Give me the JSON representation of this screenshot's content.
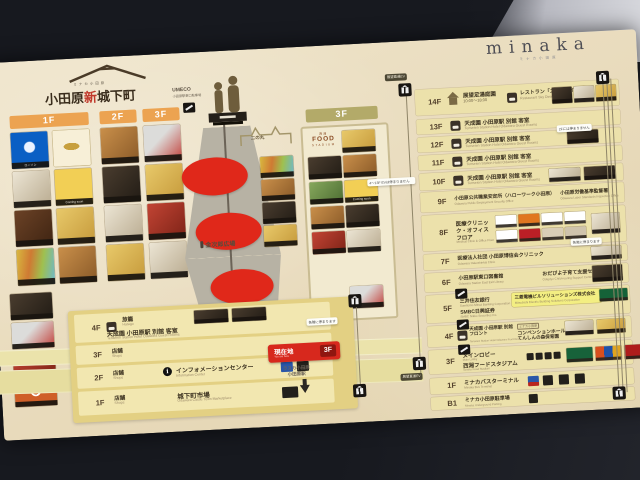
{
  "shinjokamachi": {
    "brand_small": "ミナカ小田原",
    "title_pre": "小田原",
    "title_accent": "新",
    "title_post": "城下町",
    "floor1": "1F",
    "floor2": "2F",
    "floor3": "3F",
    "lawson_label": "ローソン",
    "coming_soon": "Coming soon"
  },
  "directory": {
    "rows": [
      {
        "floor": "4F",
        "category": "旅籠",
        "category_en": "Hatago",
        "name": "天成園 小田原駅 別館 客室",
        "name_en": "Tenseien Station Hotel Odawara Guest Rooms"
      },
      {
        "floor": "3F",
        "category": "店舗",
        "category_en": "Shops",
        "name": "",
        "name_en": ""
      },
      {
        "floor": "2F",
        "category": "店舗",
        "category_en": "Shops",
        "name": "インフォメーションセンター",
        "name_en": "Information Center"
      },
      {
        "floor": "1F",
        "category": "店舗",
        "category_en": "Shops",
        "name": "城下町市場",
        "name_en": "Odawara Castle Town Marketplace"
      }
    ],
    "elevator_note": "各階に停まります"
  },
  "center": {
    "umeco": "UMECO",
    "umeco_sub": "小田原駅東口駐車場",
    "ninomaru": "二の丸",
    "plaza": "金次郎広場",
    "here_label": "現在地",
    "here_en": "You are here",
    "here_floor": "3F",
    "station_line1": "ラスカ小田原",
    "station_line2": "小田原駅"
  },
  "food_stadium": {
    "floor": "3F",
    "logo_top": "西湘",
    "logo_main": "FOOD",
    "logo_sub": "STADIUM",
    "coming_soon": "Coming soon"
  },
  "minaka": {
    "logo": "minaka",
    "logo_sub": "ミナカ小田原",
    "rows": [
      {
        "floor": "14F",
        "area": "展望足湯庭園",
        "area_time": "10:00〜18:00",
        "name": "レストラン「スカイダイニング」",
        "name_en": "Restaurant Sky Dining"
      },
      {
        "floor": "13F",
        "name": "天成園 小田原駅 別館 客室",
        "name_en": "Tenseien Station Hotel Odawara Guest Rooms"
      },
      {
        "floor": "12F",
        "name": "天成園 小田原駅 別館 客室",
        "name_en": "Tenseien Station Hotel Odawara Guest Rooms"
      },
      {
        "floor": "11F",
        "name": "天成園 小田原駅 別館 客室",
        "name_en": "Tenseien Station Hotel Odawara Guest Rooms"
      },
      {
        "floor": "10F",
        "name": "天成園 小田原駅 別館 客室",
        "name_en": "Tenseien Station Hotel Odawara Guest Rooms"
      },
      {
        "floor": "9F",
        "name": "小田原公共職業安定所（ハローワーク小田原）",
        "name_en": "Odawara Public Employment Security Office",
        "name2": "小田原労働基準監督署",
        "name2_en": "Odawara Labor Standards Inspection Office"
      },
      {
        "floor": "8F",
        "name": "医療クリニック・オフィス フロア",
        "name_en": "Medical Clinic & Office Floor"
      },
      {
        "floor": "7F",
        "name": "医療法人社団 小田原博信会クリニック",
        "name_en": "Odawara Hakushinkai Clinic"
      },
      {
        "floor": "6F",
        "name": "小田原駅東口図書館",
        "name_en": "Odawara Station East Exit Library",
        "name2": "おだぴよ子育て支援センター",
        "name2_en": "Odapiyo Child-rearing Support Center"
      },
      {
        "floor": "5F",
        "name": "三井住友銀行",
        "name_en": "Sumitomo Mitsui Banking Corporation",
        "name2": "SMBC日興証券",
        "name2_en": "SMBC Nikko Securities Inc.",
        "highlight": "三菱電機ビルソリューションズ株式会社",
        "highlight_en": "Mitsubishi Electric Building Solutions Corporation"
      },
      {
        "floor": "4F",
        "name": "天成園 小田原駅 別館 フロント",
        "name_en": "Tenseien Station Hotel Odawara Front Desk",
        "tag": "ミナカ小田原",
        "name2": "コンベンションホール",
        "name2_en": "Convention Hall",
        "name3": "てんしんの森保育園",
        "name3_en": "Tenshin no Mori Nursery School"
      },
      {
        "floor": "3F",
        "name": "メインロビー",
        "name_en": "Main Lobby",
        "name2": "西湘フードスタジアム",
        "name2_en": "Seisho Food Stadium"
      },
      {
        "floor": "1F",
        "name": "ミナカバスターミナル",
        "name_en": "Minaka Bus Terminal"
      },
      {
        "floor": "B1",
        "name": "ミナカ小田原駐車場",
        "name_en": "Minaka Underground Parking"
      }
    ],
    "tags": {
      "left_top": "展望直通EV",
      "left_mid": "4〜13F EVは停まりません",
      "left_bottom": "展望直通EV",
      "right_top": "2Fには停まりません",
      "right_mid": "各階に停まります"
    }
  }
}
